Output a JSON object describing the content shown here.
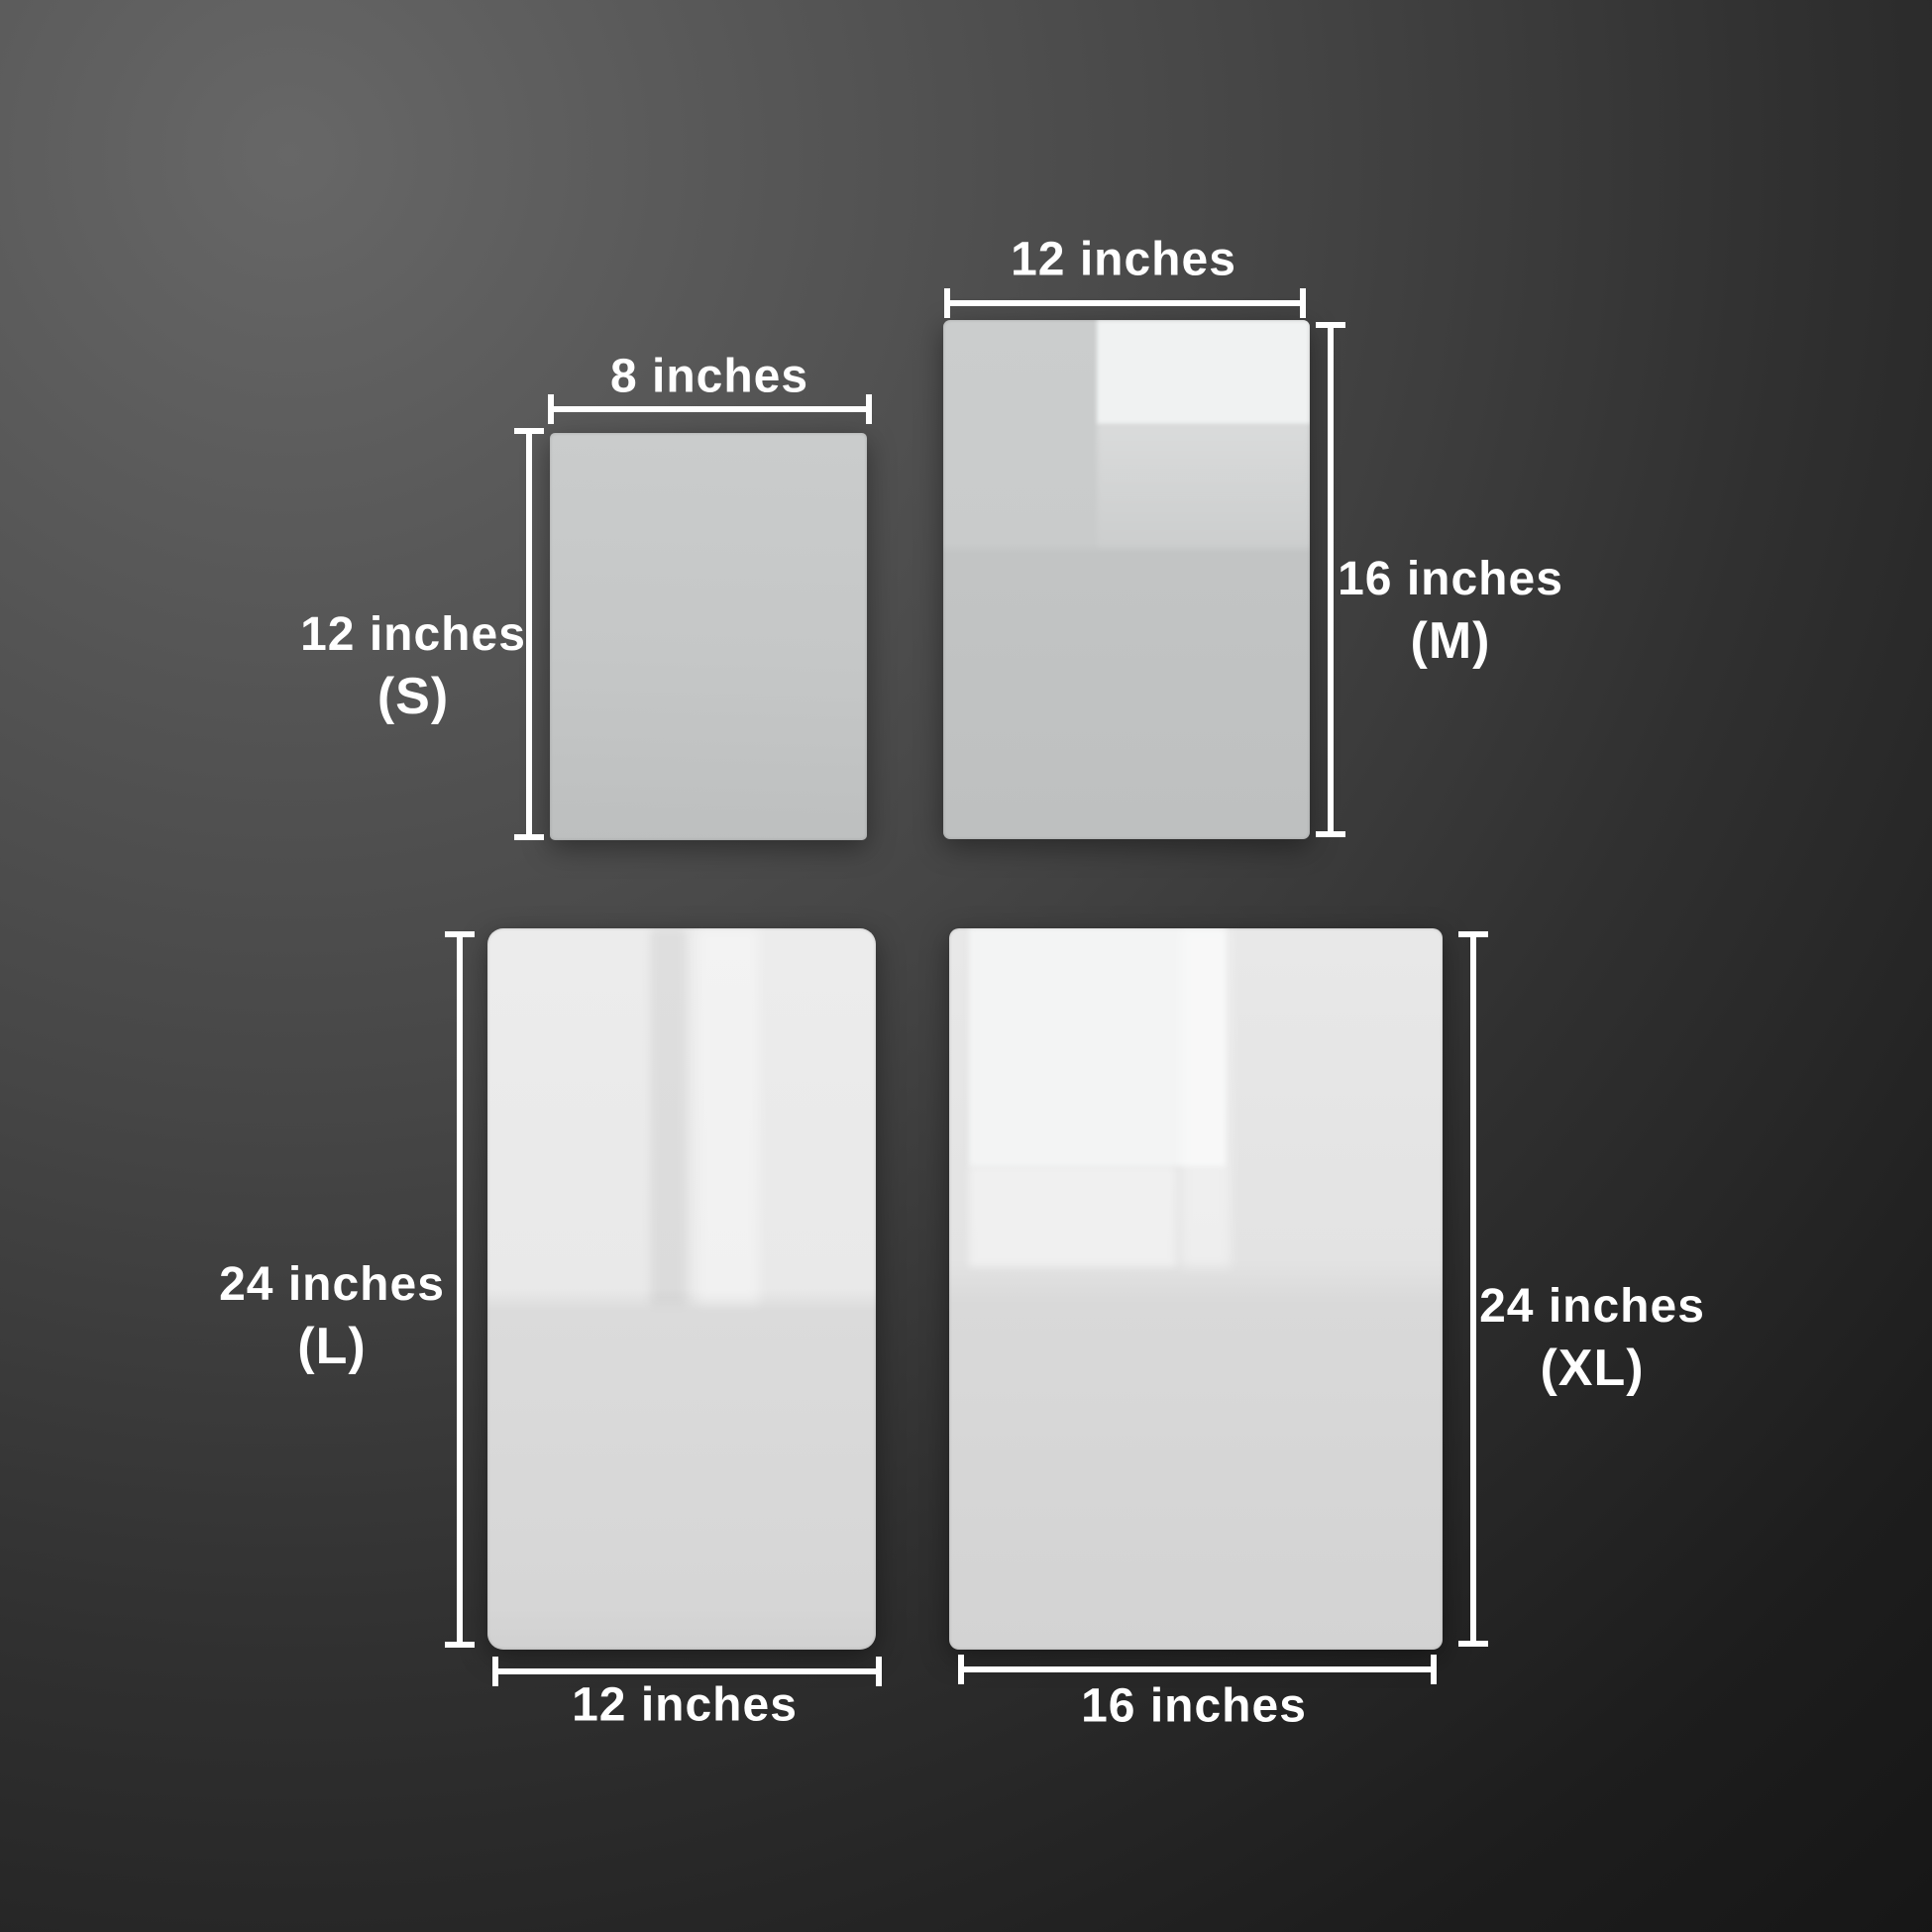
{
  "image_type": "acrylic-sheet-size-comparison",
  "colors": {
    "background_light": "#676767",
    "background_dark": "#101010",
    "dimension_lines": "#ffffff",
    "label_text": "#ffffff",
    "panel_small": "#c6c8c8",
    "panel_medium": "#c9cbcb",
    "panel_large": "#e7e7e7",
    "panel_xlarge": "#e2e2e2"
  },
  "panels": {
    "small": {
      "width_label": "8 inches",
      "height_label": "12 inches",
      "size_tag": "(S)"
    },
    "medium": {
      "width_label": "12 inches",
      "height_label": "16 inches",
      "size_tag": "(M)"
    },
    "large": {
      "width_label": "12 inches",
      "height_label": "24 inches",
      "size_tag": "(L)"
    },
    "xlarge": {
      "width_label": "16 inches",
      "height_label": "24 inches",
      "size_tag": "(XL)"
    }
  }
}
